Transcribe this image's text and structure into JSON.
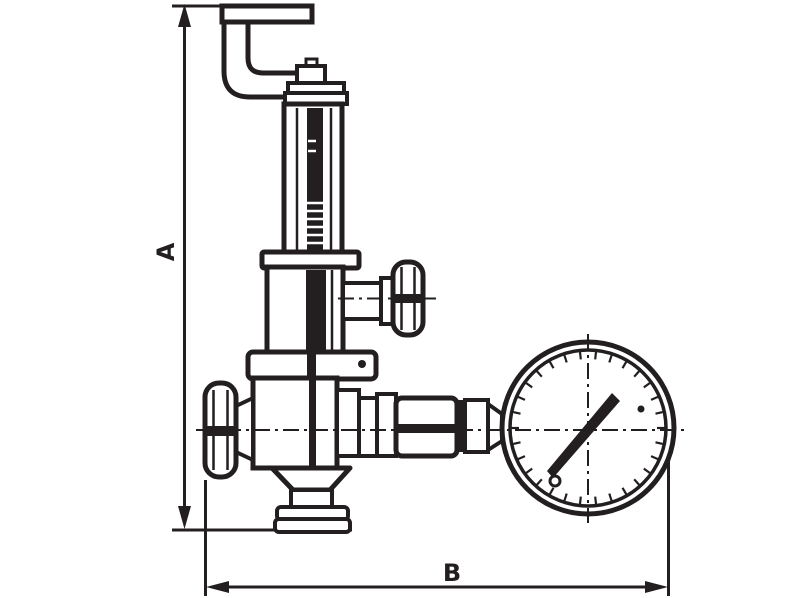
{
  "drawing": {
    "kind": "technical line drawing of a safety relief valve with pressure gauge",
    "colors": {
      "ink": "#231f20",
      "background": "#ffffff"
    }
  },
  "dimensions": {
    "height": {
      "label": "A"
    },
    "width": {
      "label": "B"
    }
  }
}
